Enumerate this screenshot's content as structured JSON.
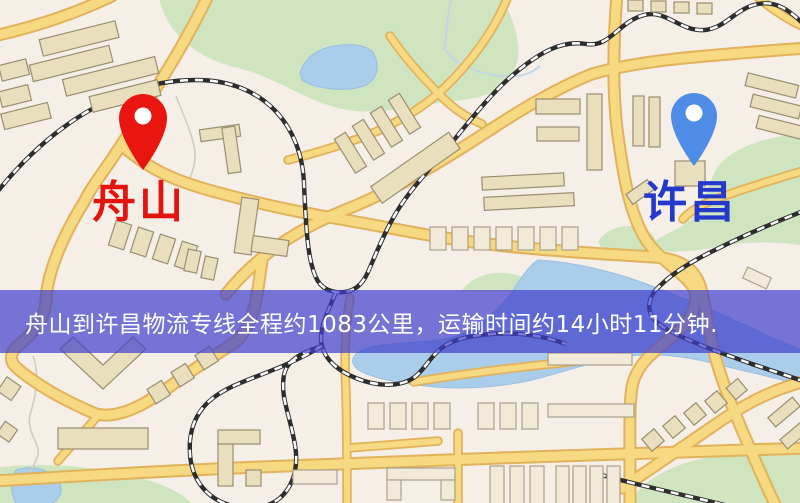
{
  "banner": {
    "text": "舟山到许昌物流专线全程约1083公里，运输时间约14小时11分钟.",
    "background_color": "#3e3ecd",
    "text_color": "#ffffff"
  },
  "map": {
    "origin": {
      "label": "舟山",
      "label_color": "#e8130c",
      "pin_color": "#ee150d"
    },
    "destination": {
      "label": "许昌",
      "label_color": "#2438d2",
      "pin_color": "#4d8cea"
    },
    "route": {
      "distance_text": "约1083公里",
      "duration_text": "约14小时11分钟"
    },
    "theme": {
      "background": "#f5efe7",
      "road_fill": "#f8d97f",
      "road_casing": "#e2b257",
      "building": "#eadfbc",
      "park": "#cfe5bf",
      "water": "#a9cdec",
      "railway": "#2d2d2d"
    }
  }
}
